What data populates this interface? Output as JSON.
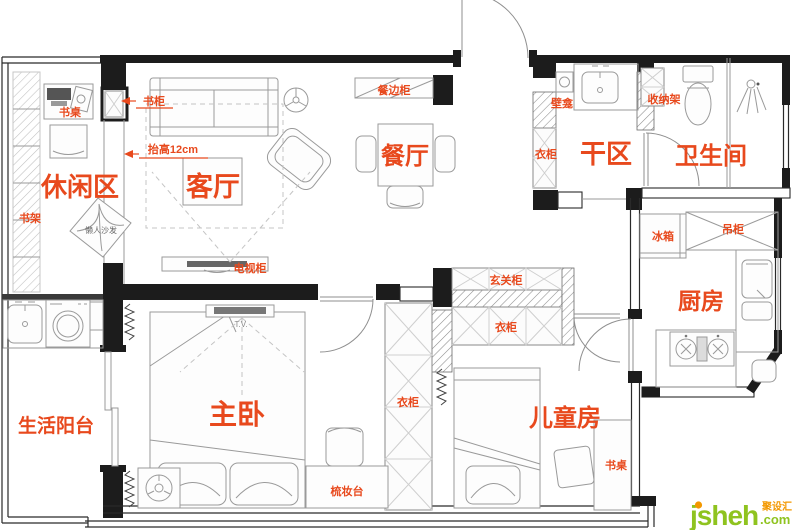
{
  "rooms": {
    "leisure": "休闲区",
    "living": "客厅",
    "dining": "餐厅",
    "dry": "干区",
    "bath": "卫生间",
    "kitchen": "厨房",
    "balcony": "生活阳台",
    "master": "主卧",
    "kids": "儿童房"
  },
  "items": {
    "desk_leisure": "书桌",
    "bookcase": "书柜",
    "bookshelf": "书架",
    "raise_note": "抬高12cm",
    "beanbag": "懒人沙发",
    "tv_cabinet": "电视柜",
    "sideboard": "餐边柜",
    "niche": "壁龛",
    "storage_rack": "收纳架",
    "wardrobe_dry": "衣柜",
    "entry_cabinet": "玄关柜",
    "wardrobe_hall": "衣柜",
    "wardrobe_master": "衣柜",
    "fridge": "冰箱",
    "hanging_cabinet": "吊柜",
    "dresser": "梳妆台",
    "desk_kids": "书桌",
    "tv_mark": "T.V."
  },
  "watermark": {
    "brand": "jsheh",
    "cn": "聚设汇",
    "suffix": ".com"
  },
  "colors": {
    "label": "#e8491d",
    "wall": "#1c1c1c",
    "furniture_line": "#9a9a9a",
    "watermark_green": "#8fc31f",
    "watermark_orange": "#f39800"
  }
}
